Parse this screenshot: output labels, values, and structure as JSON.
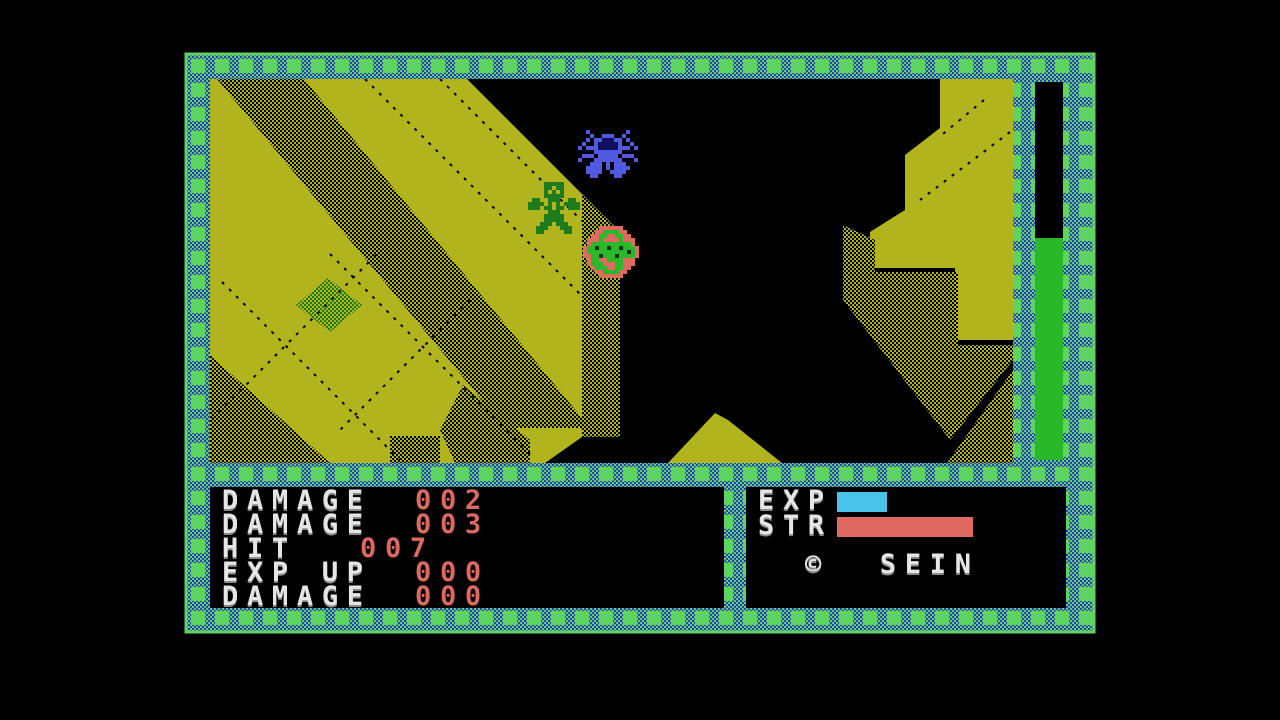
{
  "colors": {
    "background": "#000000",
    "border_green": "#5fd35f",
    "border_blue": "#2c3cc8",
    "terrain_yellow": "#b2b41e",
    "bar_green": "#29b829",
    "plant_green": "#1e7c1e",
    "spider_blue": "#4f5ae0",
    "player_green": "#1e7c1e",
    "enemy_salmon": "#e06a5e",
    "exp_bar_cyan": "#49c4e8",
    "str_bar_red": "#e06a62",
    "label_white": "#e6e6e6",
    "value_red": "#e0695f"
  },
  "message_panel": {
    "lines": [
      {
        "label": "DAMAGE",
        "value": "002"
      },
      {
        "label": "DAMAGE",
        "value": "003"
      },
      {
        "label": "HIT",
        "value": "007"
      },
      {
        "label": "EXP UP",
        "value": "000"
      },
      {
        "label": "DAMAGE",
        "value": "000"
      }
    ]
  },
  "status_panel": {
    "exp_label": "EXP",
    "str_label": "STR",
    "copyright": "©  SEIN",
    "exp_bar_width": "50",
    "str_bar_width": "136"
  },
  "health_bar": {
    "fill_height": "222"
  },
  "entities": {
    "spider": "spider-enemy",
    "player": "player-character",
    "ball": "ball-enemy"
  }
}
